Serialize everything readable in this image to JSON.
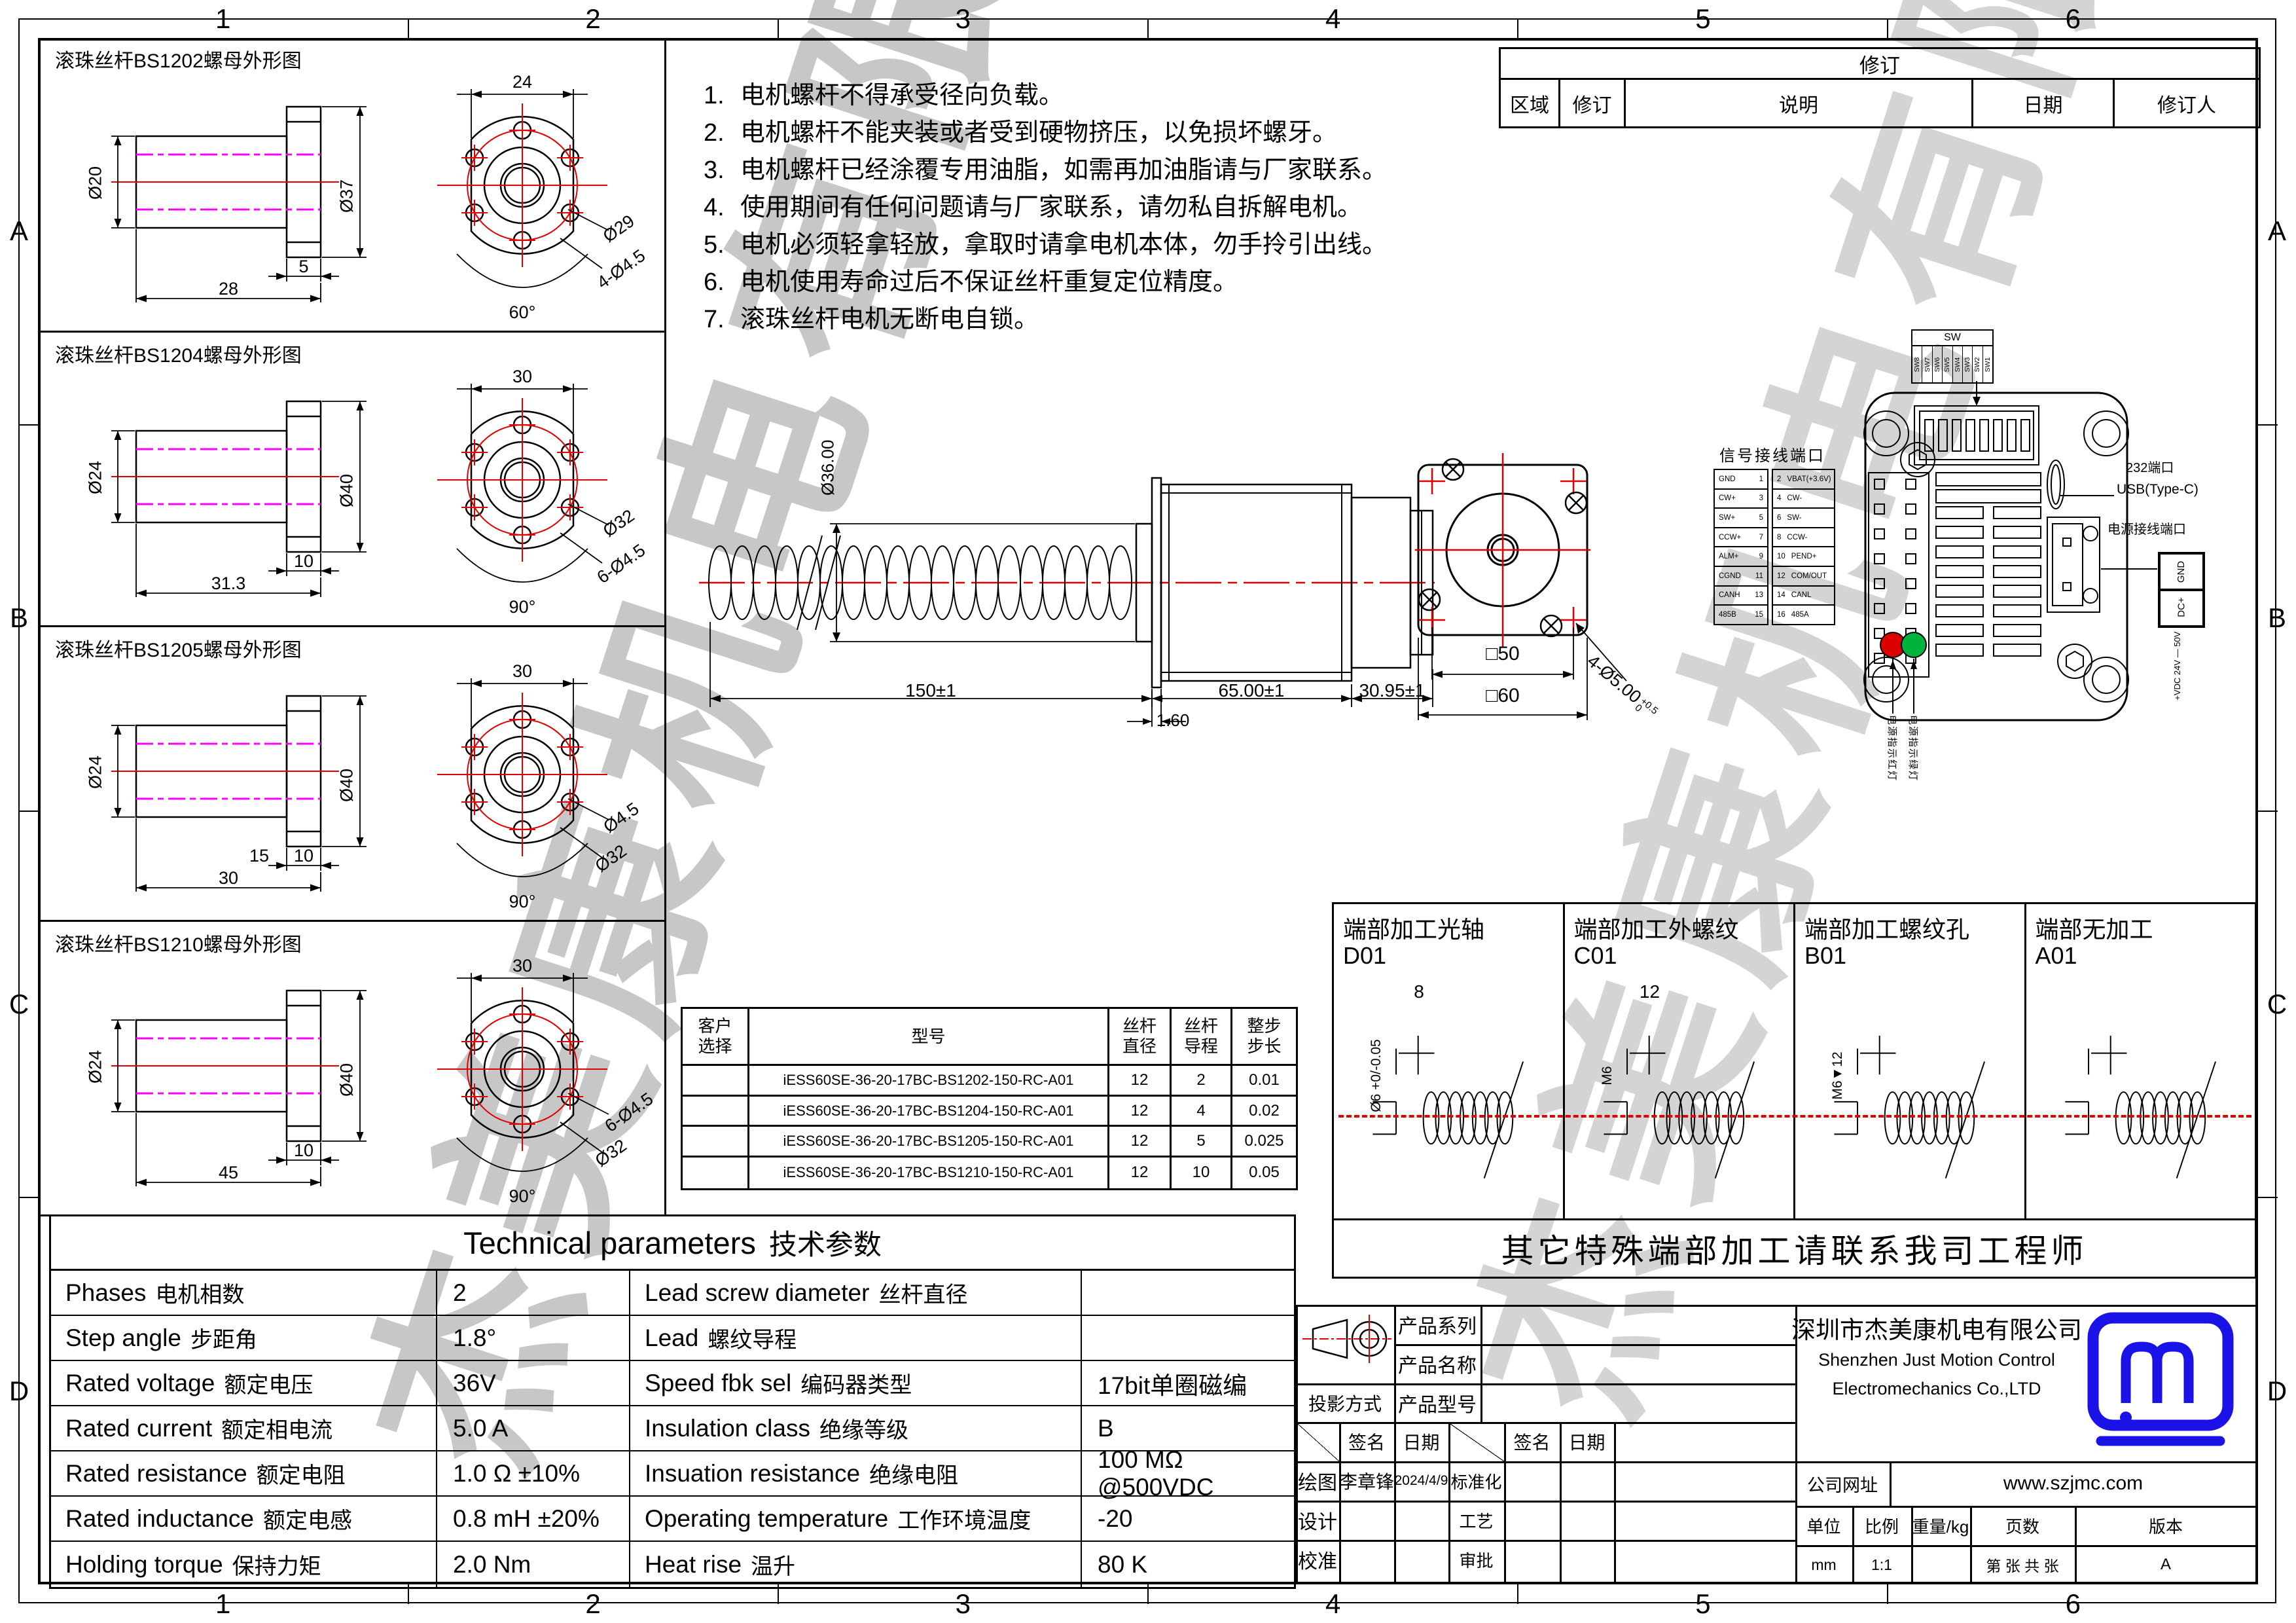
{
  "sheet": {
    "zones_top": [
      "1",
      "2",
      "3",
      "4",
      "5",
      "6"
    ],
    "zones_bottom": [
      "1",
      "2",
      "3",
      "4",
      "5",
      "6"
    ],
    "zones_left": [
      "A",
      "B",
      "C",
      "D"
    ],
    "zones_right": [
      "A",
      "B",
      "C",
      "D"
    ],
    "watermark": "杰美康机电有限公司"
  },
  "notes": {
    "items": [
      {
        "num": "1.",
        "text": "电机螺杆不得承受径向负载。"
      },
      {
        "num": "2.",
        "text": "电机螺杆不能夹装或者受到硬物挤压，以免损坏螺牙。"
      },
      {
        "num": "3.",
        "text": "电机螺杆已经涂覆专用油脂，如需再加油脂请与厂家联系。"
      },
      {
        "num": "4.",
        "text": "使用期间有任何问题请与厂家联系，请勿私自拆解电机。"
      },
      {
        "num": "5.",
        "text": "电机必须轻拿轻放，拿取时请拿电机本体，勿手拎引出线。"
      },
      {
        "num": "6.",
        "text": "电机使用寿命过后不保证丝杆重复定位精度。"
      },
      {
        "num": "7.",
        "text": "滚珠丝杆电机无断电自锁。"
      }
    ]
  },
  "revision": {
    "title": "修订",
    "col_area": "区域",
    "col_rev": "修订",
    "col_desc": "说明",
    "col_date": "日期",
    "col_by": "修订人"
  },
  "nut_panels": [
    {
      "title": "滚珠丝杆BS1202螺母外形图",
      "inner": "Ø20",
      "outer": "Ø37",
      "len_a": "5",
      "len_b": "",
      "len_c": "28",
      "front_w": "24",
      "lbl1": "Ø29",
      "lbl2": "4-Ø4.5",
      "angle": "60°"
    },
    {
      "title": "滚珠丝杆BS1204螺母外形图",
      "inner": "Ø24",
      "outer": "Ø40",
      "len_a": "10",
      "len_b": "",
      "len_c": "31.3",
      "front_w": "30",
      "lbl1": "Ø32",
      "lbl2": "6-Ø4.5",
      "angle": "90°"
    },
    {
      "title": "滚珠丝杆BS1205螺母外形图",
      "inner": "Ø24",
      "outer": "Ø40",
      "len_a": "10",
      "len_b": "15",
      "len_c": "30",
      "front_w": "30",
      "lbl1": "Ø4.5",
      "lbl2": "Ø32",
      "angle": "90°"
    },
    {
      "title": "滚珠丝杆BS1210螺母外形图",
      "inner": "Ø24",
      "outer": "Ø40",
      "len_a": "10",
      "len_b": "",
      "len_c": "45",
      "front_w": "30",
      "lbl1": "6-Ø4.5",
      "lbl2": "Ø32",
      "angle": "90°"
    }
  ],
  "main_view": {
    "dia_boss": "Ø36.00",
    "plate": "1.60",
    "len_screw": "150±1",
    "len_body": "65.00±1",
    "len_rear": "30.95±1"
  },
  "front_view": {
    "sq_inner": "□50",
    "sq_outer": "□60",
    "holes": "4-Ø5.00",
    "tol_up": "+0.5",
    "tol_dn": "0"
  },
  "signal": {
    "title": "信号接线端口",
    "rows": [
      {
        "l": "GND",
        "ln": "1",
        "rn": "2",
        "r": "VBAT(+3.6V)"
      },
      {
        "l": "CW+",
        "ln": "3",
        "rn": "4",
        "r": "CW-"
      },
      {
        "l": "SW+",
        "ln": "5",
        "rn": "6",
        "r": "SW-"
      },
      {
        "l": "CCW+",
        "ln": "7",
        "rn": "8",
        "r": "CCW-"
      },
      {
        "l": "ALM+",
        "ln": "9",
        "rn": "10",
        "r": "PEND+"
      },
      {
        "l": "CGND",
        "ln": "11",
        "rn": "12",
        "r": "COM/OUT"
      },
      {
        "l": "CANH",
        "ln": "13",
        "rn": "14",
        "r": "CANL"
      },
      {
        "l": "485B",
        "ln": "15",
        "rn": "16",
        "r": "485A"
      }
    ]
  },
  "driver": {
    "sw_title": "SW",
    "sw_labels": [
      "SW8",
      "SW7",
      "SW6",
      "SW5",
      "SW4",
      "SW3",
      "SW2",
      "SW1"
    ],
    "port232": "232端口",
    "usb": "USB(Type-C)",
    "power_title": "电源接线端口",
    "pin_gnd": "GND",
    "pin_dc": "DC+",
    "power_range": "+VDC 24V — 50V",
    "led_red": "电源指示红灯",
    "led_green": "电源指示绿灯"
  },
  "end_options": {
    "cols": [
      {
        "title": "端部加工光轴",
        "code": "D01",
        "dim_len": "8",
        "dim_dia": "Ø6 +0/-0.05"
      },
      {
        "title": "端部加工外螺纹",
        "code": "C01",
        "dim_len": "12",
        "dim_dia": "M6"
      },
      {
        "title": "端部加工螺纹孔",
        "code": "B01",
        "dim_len": "",
        "dim_dia": "M6▼12"
      },
      {
        "title": "端部无加工",
        "code": "A01",
        "dim_len": "",
        "dim_dia": ""
      }
    ],
    "note": "其它特殊端部加工请联系我司工程师"
  },
  "model_table": {
    "h_select": "客户\n选择",
    "h_model": "型号",
    "h_dia": "丝杆\n直径",
    "h_lead": "丝杆\n导程",
    "h_step": "整步\n步长",
    "rows": [
      {
        "model": "iESS60SE-36-20-17BC-BS1202-150-RC-A01",
        "dia": "12",
        "lead": "2",
        "step": "0.01"
      },
      {
        "model": "iESS60SE-36-20-17BC-BS1204-150-RC-A01",
        "dia": "12",
        "lead": "4",
        "step": "0.02"
      },
      {
        "model": "iESS60SE-36-20-17BC-BS1205-150-RC-A01",
        "dia": "12",
        "lead": "5",
        "step": "0.025"
      },
      {
        "model": "iESS60SE-36-20-17BC-BS1210-150-RC-A01",
        "dia": "12",
        "lead": "10",
        "step": "0.05"
      }
    ]
  },
  "tech": {
    "title_en": "Technical parameters",
    "title_cn": "技术参数",
    "rows": [
      {
        "l_en": "Phases",
        "l_cn": "电机相数",
        "l_val": "2",
        "r_en": "Lead screw diameter",
        "r_cn": "丝杆直径",
        "r_val": ""
      },
      {
        "l_en": "Step angle",
        "l_cn": "步距角",
        "l_val": "1.8°",
        "r_en": "Lead",
        "r_cn": "螺纹导程",
        "r_val": ""
      },
      {
        "l_en": "Rated voltage",
        "l_cn": "额定电压",
        "l_val": "36V",
        "r_en": "Speed fbk sel",
        "r_cn": "编码器类型",
        "r_val": "17bit单圈磁编"
      },
      {
        "l_en": "Rated current",
        "l_cn": "额定相电流",
        "l_val": "5.0 A",
        "r_en": "Insulation class",
        "r_cn": "绝缘等级",
        "r_val": "B"
      },
      {
        "l_en": "Rated resistance",
        "l_cn": "额定电阻",
        "l_val": "1.0 Ω  ±10%",
        "r_en": "Insuation resistance",
        "r_cn": "绝缘电阻",
        "r_val": "100 MΩ @500VDC"
      },
      {
        "l_en": "Rated inductance",
        "l_cn": "额定电感",
        "l_val": "0.8 mH ±20%",
        "r_en": "Operating temperature",
        "r_cn": "工作环境温度",
        "r_val": "-20"
      },
      {
        "l_en": "Holding torque",
        "l_cn": "保持力矩",
        "l_val": "2.0 Nm",
        "r_en": "Heat rise",
        "r_cn": "温升",
        "r_val": "80 K"
      }
    ]
  },
  "title_block": {
    "proj_label": "投影方式",
    "series": "产品系列",
    "name": "产品名称",
    "model": "产品型号",
    "sign": "签名",
    "date": "日期",
    "roles_left": [
      {
        "role": "绘图",
        "sign": "李章锋",
        "date": "2024/4/9"
      },
      {
        "role": "设计",
        "sign": "",
        "date": ""
      },
      {
        "role": "校准",
        "sign": "",
        "date": ""
      }
    ],
    "roles_right": [
      {
        "role": "标准化",
        "sign": "",
        "date": ""
      },
      {
        "role": "工艺",
        "sign": "",
        "date": ""
      },
      {
        "role": "审批",
        "sign": "",
        "date": ""
      }
    ],
    "company_cn": "深圳市杰美康机电有限公司",
    "company_en1": "Shenzhen Just Motion Control",
    "company_en2": "Electromechanics Co.,LTD",
    "web_label": "公司网址",
    "web": "www.szjmc.com",
    "unit_label": "单位",
    "unit": "mm",
    "scale_label": "比例",
    "scale": "1:1",
    "weight_label": "重量/kg",
    "weight": "",
    "pages_label": "页数",
    "pages": "第  张 共  张",
    "ver_label": "版本",
    "ver": "A",
    "logo_color": "#1b12e8"
  }
}
